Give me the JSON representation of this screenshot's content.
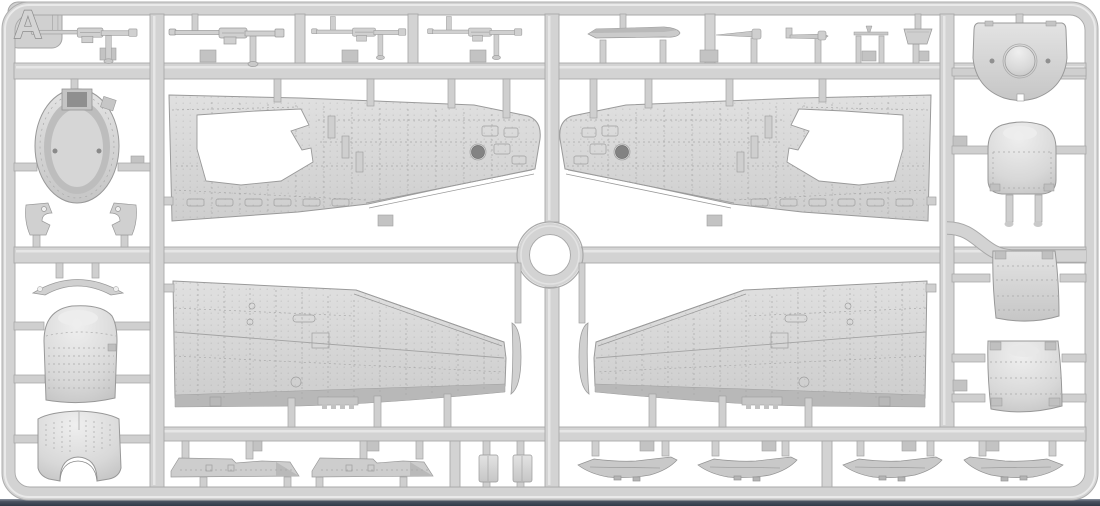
{
  "image": {
    "type": "3d-render",
    "subject": "Injection-molded plastic model kit sprue (aircraft wing and cowling parts)",
    "background": "#ffffff"
  },
  "sprue": {
    "label": "A",
    "material_color": "#d3d3d3",
    "outline_color": "#9a9a9a",
    "shadow_color": "#a9a9a9",
    "highlight_color": "#e9e9e9",
    "base_strip_color": "#3a4250"
  },
  "parts": [
    {
      "id": "machine-gun",
      "label": "machine gun",
      "count": 4,
      "location": "top row"
    },
    {
      "id": "blade-fairing",
      "label": "streamlined blade fairing",
      "count": 1,
      "location": "top row"
    },
    {
      "id": "pitot-tube",
      "label": "pitot tube",
      "count": 2,
      "location": "top row"
    },
    {
      "id": "antenna-tee",
      "label": "T-shaped antenna",
      "count": 1,
      "location": "top row"
    },
    {
      "id": "access-panel",
      "label": "trapezoid access panel",
      "count": 1,
      "location": "top row"
    },
    {
      "id": "firewall-disc",
      "label": "engine firewall bulkhead disc",
      "count": 1,
      "location": "top right corner"
    },
    {
      "id": "cowl-front-ring",
      "label": "cowling front ring",
      "count": 1,
      "location": "left column"
    },
    {
      "id": "hinge-bracket",
      "label": "hinged bracket",
      "count": 2,
      "location": "left column"
    },
    {
      "id": "intake-arc",
      "label": "intake lip arc",
      "count": 1,
      "location": "left column"
    },
    {
      "id": "cowling-front",
      "label": "engine cowling front section",
      "count": 1,
      "location": "left column"
    },
    {
      "id": "cowling-lower",
      "label": "engine cowling lower lip with cutout",
      "count": 1,
      "location": "left column"
    },
    {
      "id": "cowling-top-panel",
      "label": "cowling top panel",
      "count": 1,
      "location": "right column"
    },
    {
      "id": "cowling-mid-panel",
      "label": "cowling middle panel",
      "count": 1,
      "location": "right column"
    },
    {
      "id": "cowling-side-panel",
      "label": "cowling side panel",
      "count": 1,
      "location": "right column"
    },
    {
      "id": "wing-skin-upper",
      "label": "upper wing skin with wheel-well opening",
      "count": 2,
      "location": "upper center, mirrored pair"
    },
    {
      "id": "wing-skin-lower",
      "label": "lower wing skin",
      "count": 2,
      "location": "lower center, mirrored pair"
    },
    {
      "id": "wingtip-insert",
      "label": "wingtip leading-edge insert",
      "count": 2,
      "location": "lower center"
    },
    {
      "id": "flap-strip",
      "label": "flap / aileron strip",
      "count": 2,
      "location": "bottom row"
    },
    {
      "id": "hinge-block",
      "label": "small rectangular block",
      "count": 2,
      "location": "bottom row"
    },
    {
      "id": "bay-fairing",
      "label": "wheel-bay fairing",
      "count": 4,
      "location": "bottom row"
    }
  ]
}
